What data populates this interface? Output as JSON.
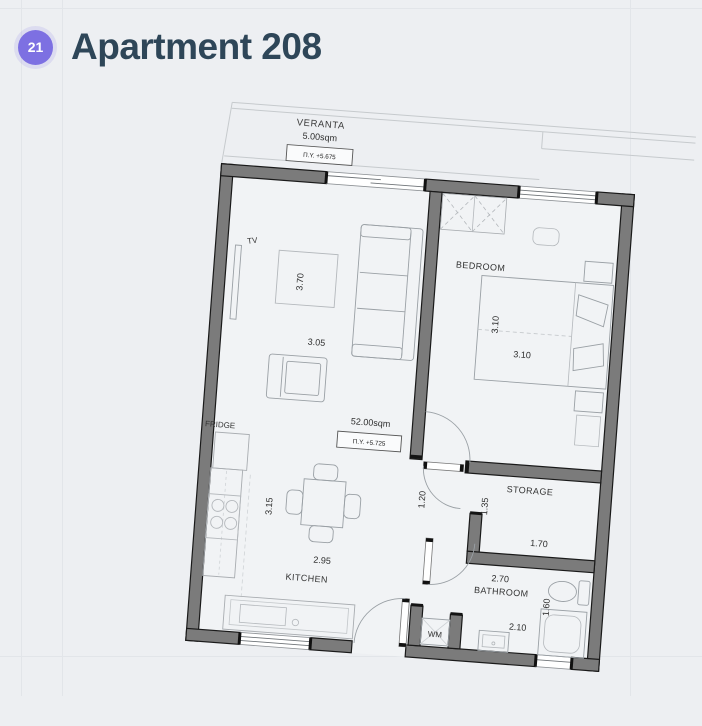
{
  "header": {
    "badge": "21",
    "title": "Apartment 208"
  },
  "colors": {
    "accent": "#7d70e2",
    "title": "#2e4658",
    "wall": "#7b7b7b",
    "background": "#edeff2"
  },
  "plan": {
    "veranta": {
      "label": "VERANTA",
      "area": "5.00sqm",
      "elevation": "Π.Υ. +5.675"
    },
    "living": {
      "tv": "TV",
      "fridge": "FRIDGE",
      "rug_dim": "3.70",
      "width_dim": "3.05",
      "area": "52.00sqm",
      "elevation": "Π.Υ. +5.725"
    },
    "kitchen": {
      "label": "KITCHEN",
      "depth_dim": "3.15",
      "width_dim": "2.95"
    },
    "hall": {
      "width_dim": "1.20"
    },
    "bedroom": {
      "label": "BEDROOM",
      "depth_dim": "3.10",
      "width_dim": "3.10"
    },
    "storage": {
      "label": "STORAGE",
      "depth_dim": "1.35",
      "width_dim": "1.70"
    },
    "bathroom": {
      "label": "BATHROOM",
      "width_dim": "2.70",
      "length_dim": "1.60",
      "width2_dim": "2.10",
      "wm": "WM"
    }
  }
}
